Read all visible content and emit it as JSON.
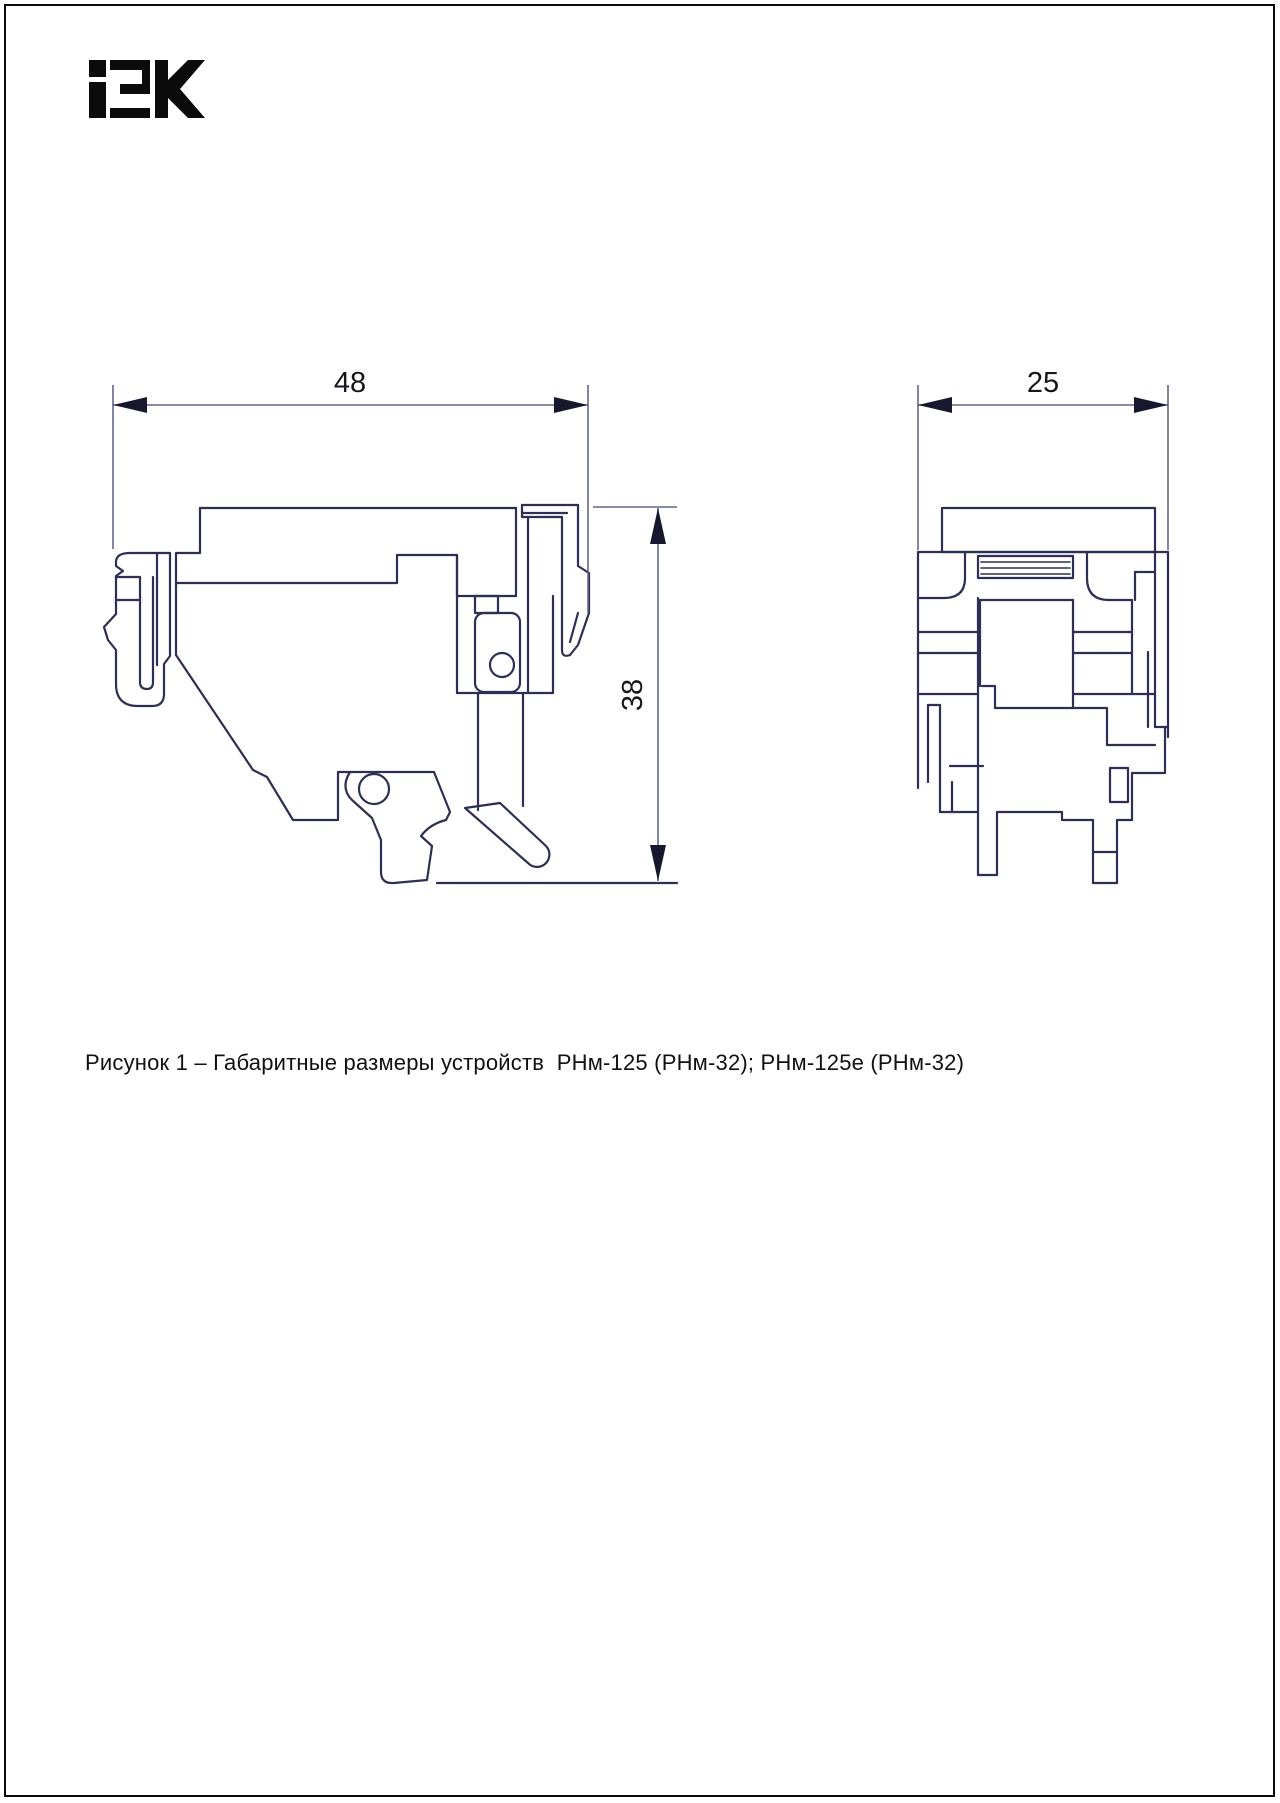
{
  "logo": {
    "text": "iEK",
    "alt": "IEK brand logo"
  },
  "figure": {
    "caption": "Рисунок 1 – Габаритные размеры устройств  РНм-125 (РНм-32); РНм-125е (РНм-32)",
    "figure_number": "1",
    "device_models": [
      "РНм-125 (РНм-32)",
      "РНм-125е (РНм-32)"
    ],
    "views": {
      "side_view": {
        "name": "side-view",
        "width_mm": "48",
        "height_mm": "38"
      },
      "front_view": {
        "name": "front-view",
        "width_mm": "25"
      }
    }
  },
  "dimensions": {
    "side_width": "48",
    "side_height": "38",
    "front_width": "25"
  },
  "colors": {
    "drawing_line": "#2d2f55",
    "dimension_line": "#62678a",
    "dimension_arrow": "#16182e",
    "text": "#111111",
    "page_border": "#0a0a0a"
  }
}
